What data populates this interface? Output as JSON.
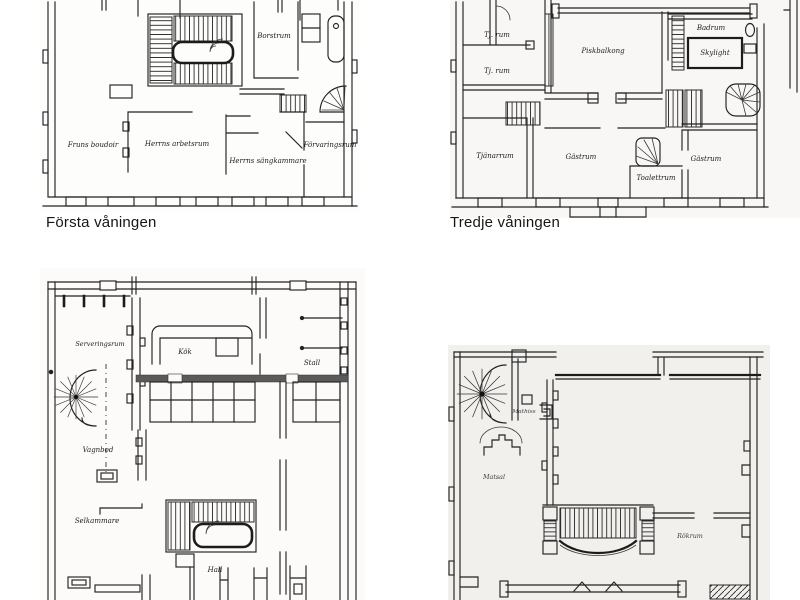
{
  "page": {
    "background": "#ffffff",
    "ink": "#1f1f1f",
    "dark_wall": "#5a5a5a"
  },
  "plans": {
    "first": {
      "caption": "Första våningen",
      "rooms": {
        "borstrum": "Borstrum",
        "fruns_boudoir": "Fruns boudoir",
        "herrns_arbetsrum": "Herrns arbetsrum",
        "herrns_sangkammare": "Herrns sängkammare",
        "forvaringsrum": "Förvaringsrum"
      }
    },
    "third": {
      "caption": "Tredje våningen",
      "rooms": {
        "tj_rum_1": "Tj. rum",
        "tj_rum_2": "Tj. rum",
        "piskbalkong": "Piskbalkong",
        "badrum": "Badrum",
        "skylight": "Skylight",
        "tjanarrum": "Tjänarrum",
        "gastrum_center": "Gästrum",
        "toalettrum": "Toalettrum",
        "gastrum_right": "Gästrum"
      }
    },
    "ground": {
      "rooms": {
        "serveringsrum": "Serveringsrum",
        "kok": "Kök",
        "stall": "Stall",
        "vagnbod": "Vagnbod",
        "selkammare": "Selkammare",
        "hall": "Hall"
      }
    },
    "second": {
      "rooms": {
        "mathiss": "Mathiss",
        "matsal": "Matsal",
        "rokrum": "Rökrum"
      }
    }
  }
}
